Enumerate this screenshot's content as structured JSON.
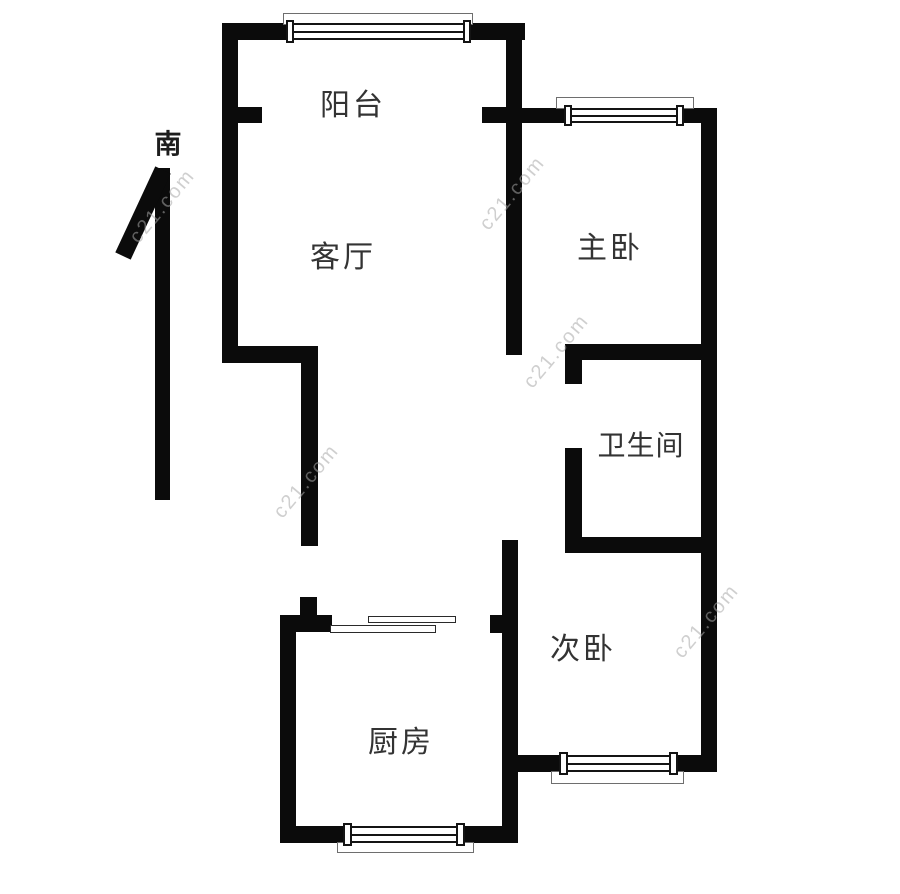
{
  "compass": {
    "label": "南"
  },
  "rooms": {
    "balcony": "阳台",
    "living_room": "客厅",
    "master_bedroom": "主卧",
    "bathroom": "卫生间",
    "second_bedroom": "次卧",
    "kitchen": "厨房"
  },
  "watermark": {
    "text": "c21.com"
  },
  "colors": {
    "wall": "#0b0b0b",
    "label": "#333333",
    "bg": "#ffffff"
  }
}
